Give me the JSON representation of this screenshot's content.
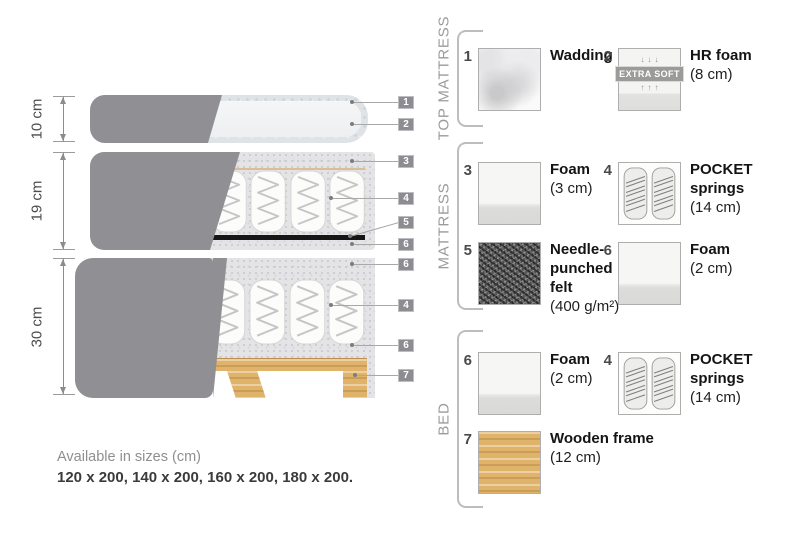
{
  "diagram": {
    "dimensions": [
      {
        "label": "10 cm"
      },
      {
        "label": "19 cm"
      },
      {
        "label": "30 cm"
      }
    ],
    "callouts": [
      "1",
      "2",
      "3",
      "4",
      "5",
      "6",
      "6",
      "4",
      "6",
      "7"
    ],
    "note": {
      "line1": "Available in sizes (cm)",
      "line2": "120 x 200, 140 x 200, 160 x 200, 180 x 200."
    }
  },
  "legend": {
    "groups": [
      {
        "label": "TOP MATTRESS",
        "items": [
          {
            "num": "1",
            "title": "Wadding",
            "size": ""
          },
          {
            "num": "2",
            "title": "HR foam",
            "size": "(8 cm)",
            "badge": "EXTRA SOFT",
            "arrows_down": "↓↓↓",
            "arrows_up": "↑↑↑"
          }
        ]
      },
      {
        "label": "MATTRESS",
        "items": [
          {
            "num": "3",
            "title": "Foam",
            "size": "(3 cm)"
          },
          {
            "num": "4",
            "title": "POCKET\nsprings",
            "size": "(14 cm)"
          },
          {
            "num": "5",
            "title": "Needle-\npunched\nfelt",
            "size": "(400 g/m²)"
          },
          {
            "num": "6",
            "title": "Foam",
            "size": "(2 cm)"
          }
        ]
      },
      {
        "label": "BED",
        "items": [
          {
            "num": "6",
            "title": "Foam",
            "size": "(2 cm)"
          },
          {
            "num": "4",
            "title": "POCKET\nsprings",
            "size": "(14 cm)"
          },
          {
            "num": "7",
            "title": "Wooden frame",
            "size": "(12 cm)"
          }
        ]
      }
    ]
  },
  "colors": {
    "cover_fabric": "#909094",
    "foam_casing": "#e4e4e6",
    "needle_felt_strip": "#161616",
    "wood": "#e0b36a",
    "callout_tag": "#8d8d91",
    "text_dark": "#141414",
    "text_gray": "#9b9b9b"
  }
}
